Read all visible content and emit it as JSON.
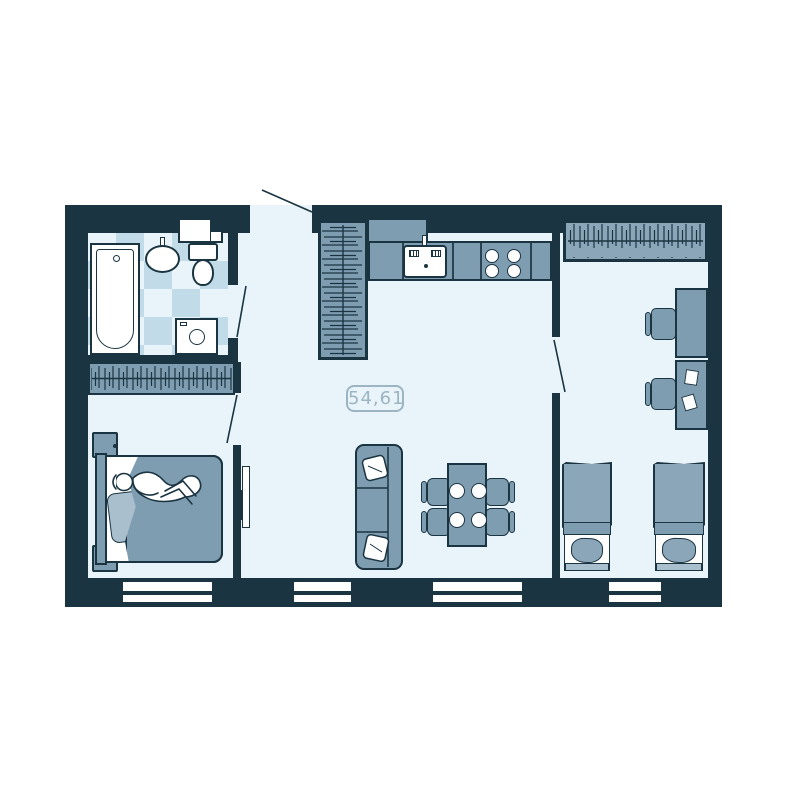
{
  "plan": {
    "area_label": "54,61"
  },
  "colors": {
    "bg": "#ffffff",
    "wall": "#1b3442",
    "floor": "#e8f4fa",
    "tile": "#c2dbe8",
    "furn": "#7e9db1",
    "furn-alt": "#8aa6b8",
    "furn-light": "#a9bfcd",
    "label": "#9db4c2"
  },
  "rooms": [
    {
      "id": "bathroom",
      "furniture": [
        "bathtub",
        "wash-basin",
        "toilet",
        "wall-shelf",
        "washing-machine",
        "tiled-floor"
      ]
    },
    {
      "id": "bedroom",
      "furniture": [
        "built-in-wardrobe",
        "double-bed",
        "sleeping-person",
        "nightstand",
        "nightstand",
        "wall-tv"
      ]
    },
    {
      "id": "kitchen-living-room",
      "furniture": [
        "tall-wardrobe",
        "upper-cabinet",
        "kitchen-counter",
        "kitchen-sink",
        "stove-4-burners",
        "sofa",
        "sofa-pillows",
        "dining-table",
        "plates-x4",
        "dining-chairs-x4"
      ]
    },
    {
      "id": "kids-room",
      "furniture": [
        "wardrobe",
        "desk",
        "desk-with-papers",
        "chair",
        "chair",
        "single-bed",
        "single-bed"
      ]
    }
  ],
  "openings": {
    "windows_count": 4,
    "doors": [
      "entrance-door",
      "bathroom-door",
      "bedroom-door",
      "kids-room-door"
    ]
  }
}
